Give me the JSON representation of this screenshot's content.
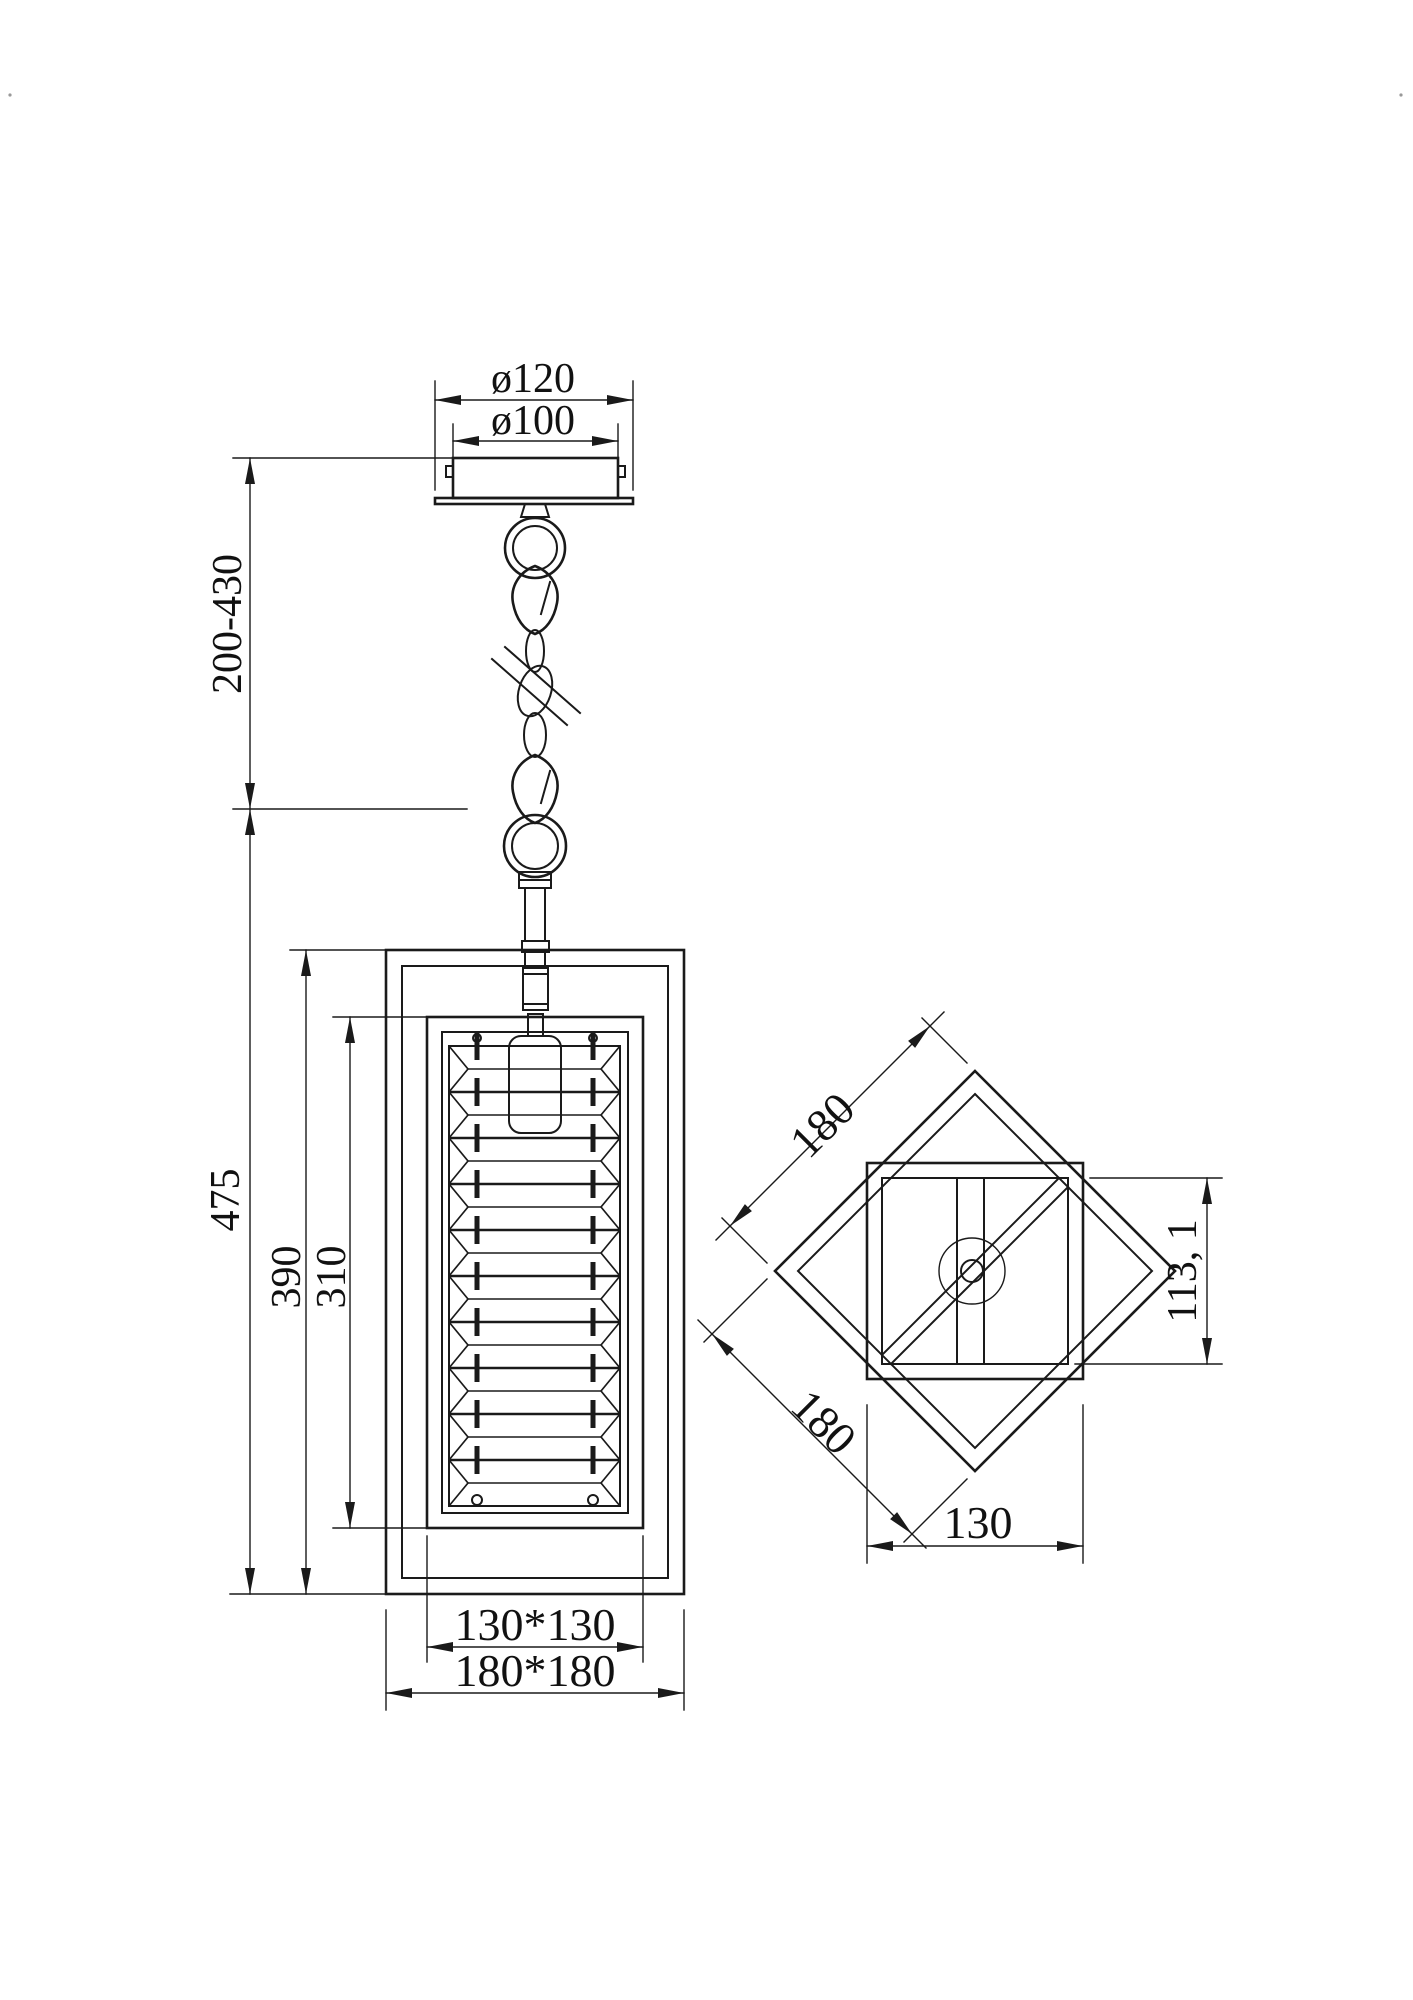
{
  "drawing": {
    "background": "#ffffff",
    "line_color": "#1a1a1a",
    "dimensions": {
      "canopy_outer_diameter": "ø120",
      "canopy_inner_diameter": "ø100",
      "suspension_range": "200-430",
      "total_height": "475",
      "outer_frame_height": "390",
      "inner_frame_height": "310",
      "inner_frame_footprint": "130*130",
      "outer_frame_footprint": "180*180",
      "plan_side_top": "180",
      "plan_side_bottom": "180",
      "plan_inner_height": "113, 1",
      "plan_inner_width": "130"
    },
    "stack": {
      "rows": 10
    }
  }
}
